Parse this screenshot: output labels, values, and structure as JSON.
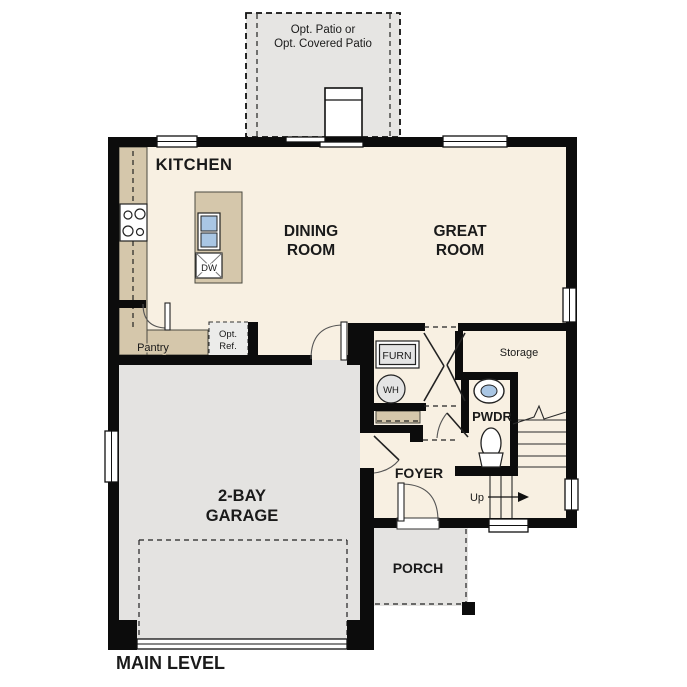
{
  "floor_plan": {
    "title": "MAIN LEVEL",
    "patio": {
      "line1": "Opt. Patio or",
      "line2": "Opt. Covered Patio"
    },
    "kitchen": {
      "label": "KITCHEN",
      "pantry": "Pantry",
      "dishwasher": "DW",
      "opt_ref_line1": "Opt.",
      "opt_ref_line2": "Ref."
    },
    "dining": {
      "line1": "DINING",
      "line2": "ROOM"
    },
    "great": {
      "line1": "GREAT",
      "line2": "ROOM"
    },
    "utility": {
      "furnace": "FURN",
      "water_heater": "WH",
      "storage": "Storage"
    },
    "powder": {
      "label": "PWDR"
    },
    "foyer": {
      "label": "FOYER"
    },
    "stairs": {
      "up": "Up"
    },
    "garage": {
      "line1": "2-BAY",
      "line2": "GARAGE"
    },
    "porch": {
      "label": "PORCH"
    },
    "colors": {
      "wall": "#0c0c0c",
      "floor": "#f8f0e2",
      "concrete": "#e4e3e1",
      "counter": "#d5c7ab",
      "sink_blue": "#a9c6e4",
      "fixture_gray": "#e4e4e4"
    }
  }
}
